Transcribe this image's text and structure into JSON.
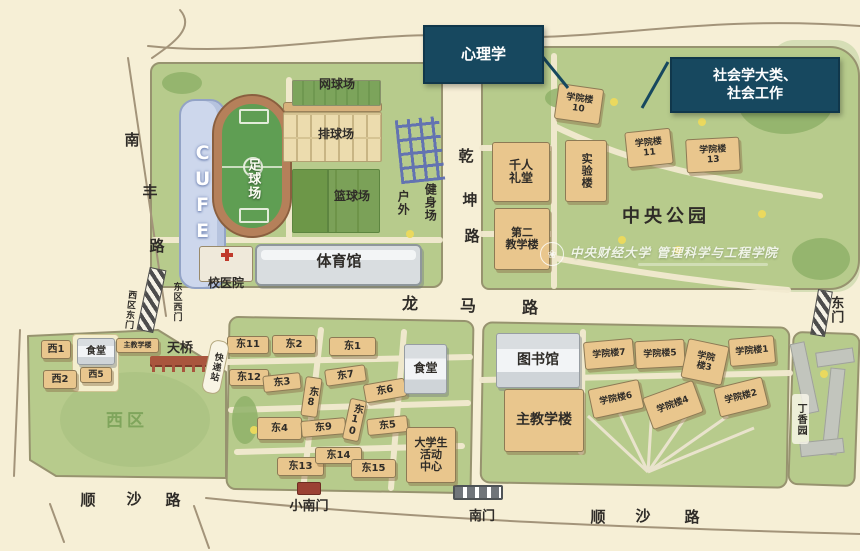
{
  "callouts": {
    "psychology": "心理学",
    "sociology": "社会学大类、\n社会工作"
  },
  "watermark": {
    "university": "中央财经大学",
    "school": "管理科学与工程学院",
    "logo_icon": "flower-emblem"
  },
  "map": {
    "colors": {
      "paper": "#f6efd6",
      "campus_green": "#b7cb8c",
      "building_tan": "#e9c68d",
      "building_gray": "#d9dde0",
      "callout_blue": "#17485f",
      "track_brown": "#b5805a",
      "field_green": "#5f9e53",
      "stand_blue": "#cdd7ec",
      "road_outline": "#a3947a"
    },
    "items": [
      {
        "n": "label-cufe-stand",
        "t": "CUFE",
        "x": 186,
        "y": 114,
        "w": 32,
        "h": 160,
        "c": "v cufe",
        "s": 19
      },
      {
        "n": "label-football-field",
        "t": "足球场",
        "x": 241,
        "y": 146,
        "w": 22,
        "h": 66,
        "c": "v white",
        "s": 13
      },
      {
        "n": "label-tennis-court",
        "t": "网球场",
        "x": 305,
        "y": 77,
        "w": 64,
        "h": 16,
        "c": "lab",
        "s": 12
      },
      {
        "n": "label-volleyball-court",
        "t": "排球场",
        "x": 304,
        "y": 127,
        "w": 64,
        "h": 16,
        "c": "lab",
        "s": 12
      },
      {
        "n": "label-basketball-court",
        "t": "篮球场",
        "x": 320,
        "y": 189,
        "w": 64,
        "h": 16,
        "c": "lab",
        "s": 12
      },
      {
        "n": "label-outdoor",
        "t": "户外",
        "x": 394,
        "y": 184,
        "w": 17,
        "h": 38,
        "c": "v lab",
        "s": 12
      },
      {
        "n": "label-fitness-area",
        "t": "健身场",
        "x": 421,
        "y": 174,
        "w": 17,
        "h": 56,
        "c": "v lab",
        "s": 12
      },
      {
        "n": "label-gymnasium",
        "t": "体育馆",
        "x": 296,
        "y": 250,
        "w": 86,
        "h": 22,
        "c": "lab",
        "s": 15
      },
      {
        "n": "label-school-hospital",
        "t": "校医院",
        "x": 198,
        "y": 276,
        "w": 56,
        "h": 16,
        "c": "lab",
        "s": 12
      },
      {
        "n": "road-nanfeng-char-1",
        "t": "南",
        "x": 122,
        "y": 130,
        "w": 20,
        "h": 20,
        "c": "lab",
        "s": 15
      },
      {
        "n": "road-nanfeng-char-2",
        "t": "丰",
        "x": 140,
        "y": 182,
        "w": 20,
        "h": 20,
        "c": "lab",
        "s": 15
      },
      {
        "n": "road-nanfeng-char-3",
        "t": "路",
        "x": 147,
        "y": 236,
        "w": 20,
        "h": 20,
        "c": "lab",
        "s": 15
      },
      {
        "n": "road-qiankun-char-1",
        "t": "乾",
        "x": 456,
        "y": 146,
        "w": 20,
        "h": 20,
        "c": "lab",
        "s": 15
      },
      {
        "n": "road-qiankun-char-2",
        "t": "坤",
        "x": 460,
        "y": 190,
        "w": 20,
        "h": 20,
        "c": "lab",
        "s": 15
      },
      {
        "n": "road-qiankun-char-3",
        "t": "路",
        "x": 462,
        "y": 226,
        "w": 20,
        "h": 20,
        "c": "lab",
        "s": 15
      },
      {
        "n": "road-longma-char-1",
        "t": "龙",
        "x": 400,
        "y": 294,
        "w": 20,
        "h": 20,
        "c": "lab",
        "s": 16
      },
      {
        "n": "road-longma-char-2",
        "t": "马",
        "x": 458,
        "y": 296,
        "w": 20,
        "h": 20,
        "c": "lab",
        "s": 16
      },
      {
        "n": "road-longma-char-3",
        "t": "路",
        "x": 520,
        "y": 298,
        "w": 20,
        "h": 20,
        "c": "lab",
        "s": 16
      },
      {
        "n": "road-shunsha-west-char-1",
        "t": "顺",
        "x": 78,
        "y": 490,
        "w": 20,
        "h": 20,
        "c": "lab",
        "s": 15
      },
      {
        "n": "road-shunsha-west-char-2",
        "t": "沙",
        "x": 124,
        "y": 489,
        "w": 20,
        "h": 20,
        "c": "lab",
        "s": 15
      },
      {
        "n": "road-shunsha-west-char-3",
        "t": "路",
        "x": 163,
        "y": 490,
        "w": 20,
        "h": 20,
        "c": "lab",
        "s": 15
      },
      {
        "n": "road-shunsha-east-char-1",
        "t": "顺",
        "x": 588,
        "y": 507,
        "w": 20,
        "h": 20,
        "c": "lab",
        "s": 15
      },
      {
        "n": "road-shunsha-east-char-2",
        "t": "沙",
        "x": 633,
        "y": 506,
        "w": 20,
        "h": 20,
        "c": "lab",
        "s": 15
      },
      {
        "n": "road-shunsha-east-char-3",
        "t": "路",
        "x": 682,
        "y": 507,
        "w": 20,
        "h": 20,
        "c": "lab",
        "s": 15
      },
      {
        "n": "label-east-gate",
        "t": "东门",
        "x": 826,
        "y": 288,
        "w": 18,
        "h": 44,
        "c": "v lab",
        "s": 13
      },
      {
        "n": "label-west-campus-east-gate",
        "t": "西区东门",
        "x": 122,
        "y": 281,
        "w": 15,
        "h": 58,
        "c": "v lab",
        "s": 9,
        "r": 6
      },
      {
        "n": "label-east-campus-west-gate",
        "t": "东区西门",
        "x": 169,
        "y": 273,
        "w": 15,
        "h": 58,
        "c": "v lab",
        "s": 9
      },
      {
        "n": "label-small-south-gate",
        "t": "小南门",
        "x": 282,
        "y": 499,
        "w": 54,
        "h": 16,
        "c": "lab",
        "s": 13
      },
      {
        "n": "label-south-gate",
        "t": "南门",
        "x": 460,
        "y": 509,
        "w": 44,
        "h": 16,
        "c": "lab",
        "s": 13
      },
      {
        "n": "building-college-10",
        "t": "学院楼\n10",
        "x": 556,
        "y": 86,
        "w": 46,
        "h": 36,
        "c": "bld",
        "s": 9,
        "r": 8
      },
      {
        "n": "building-college-11",
        "t": "学院楼\n11",
        "x": 626,
        "y": 130,
        "w": 46,
        "h": 36,
        "c": "bld",
        "s": 9,
        "r": -6
      },
      {
        "n": "building-college-13",
        "t": "学院楼\n13",
        "x": 686,
        "y": 138,
        "w": 54,
        "h": 34,
        "c": "bld",
        "s": 9,
        "r": -3
      },
      {
        "n": "building-thousand-people-hall",
        "t": "千人\n礼堂",
        "x": 492,
        "y": 142,
        "w": 58,
        "h": 60,
        "c": "bld",
        "s": 12
      },
      {
        "n": "building-laboratory",
        "t": "实验楼",
        "x": 565,
        "y": 140,
        "w": 42,
        "h": 62,
        "c": "bld v",
        "s": 11
      },
      {
        "n": "building-second-teaching",
        "t": "第二\n教学楼",
        "x": 494,
        "y": 208,
        "w": 56,
        "h": 62,
        "c": "bld",
        "s": 11
      },
      {
        "n": "label-central-park",
        "t": "中央公园",
        "x": 598,
        "y": 204,
        "w": 136,
        "h": 26,
        "c": "lab ls",
        "s": 18
      },
      {
        "n": "building-west-1",
        "t": "西1",
        "x": 41,
        "y": 340,
        "w": 30,
        "h": 19,
        "c": "bld",
        "s": 10
      },
      {
        "n": "building-west-2",
        "t": "西2",
        "x": 43,
        "y": 370,
        "w": 34,
        "h": 19,
        "c": "bld",
        "s": 10
      },
      {
        "n": "building-west-canteen",
        "t": "食堂",
        "x": 77,
        "y": 338,
        "w": 38,
        "h": 27,
        "c": "gray",
        "s": 10
      },
      {
        "n": "building-west-5",
        "t": "西5",
        "x": 80,
        "y": 367,
        "w": 32,
        "h": 16,
        "c": "bld",
        "s": 9
      },
      {
        "n": "building-west-main-teaching",
        "t": "主教学楼",
        "x": 116,
        "y": 338,
        "w": 43,
        "h": 15,
        "c": "bld",
        "s": 7
      },
      {
        "n": "label-west-campus",
        "t": "西区",
        "x": 92,
        "y": 410,
        "w": 70,
        "h": 24,
        "c": "lab green ls",
        "s": 17
      },
      {
        "n": "building-east-11",
        "t": "东11",
        "x": 227,
        "y": 336,
        "w": 42,
        "h": 18,
        "c": "bld",
        "s": 10
      },
      {
        "n": "building-east-2",
        "t": "东2",
        "x": 272,
        "y": 335,
        "w": 44,
        "h": 19,
        "c": "bld",
        "s": 10
      },
      {
        "n": "building-east-1",
        "t": "东1",
        "x": 329,
        "y": 337,
        "w": 47,
        "h": 19,
        "c": "bld",
        "s": 10
      },
      {
        "n": "building-east-12",
        "t": "东12",
        "x": 229,
        "y": 369,
        "w": 40,
        "h": 17,
        "c": "bld",
        "s": 10
      },
      {
        "n": "building-east-3",
        "t": "东3",
        "x": 263,
        "y": 374,
        "w": 38,
        "h": 17,
        "c": "bld",
        "s": 10,
        "r": -6
      },
      {
        "n": "building-east-8",
        "t": "东8",
        "x": 303,
        "y": 377,
        "w": 17,
        "h": 40,
        "c": "bld v",
        "s": 10,
        "r": 8
      },
      {
        "n": "building-east-7",
        "t": "东7",
        "x": 325,
        "y": 367,
        "w": 41,
        "h": 17,
        "c": "bld",
        "s": 10,
        "r": -8
      },
      {
        "n": "building-east-6",
        "t": "东6",
        "x": 364,
        "y": 381,
        "w": 42,
        "h": 19,
        "c": "bld",
        "s": 10,
        "r": -10
      },
      {
        "n": "building-east-4",
        "t": "东4",
        "x": 257,
        "y": 417,
        "w": 45,
        "h": 23,
        "c": "bld",
        "s": 10
      },
      {
        "n": "building-east-9",
        "t": "东9",
        "x": 301,
        "y": 419,
        "w": 45,
        "h": 17,
        "c": "bld",
        "s": 10,
        "r": -5
      },
      {
        "n": "building-east-10",
        "t": "东10",
        "x": 346,
        "y": 399,
        "w": 17,
        "h": 42,
        "c": "bld v",
        "s": 10,
        "r": 12
      },
      {
        "n": "building-east-5",
        "t": "东5",
        "x": 367,
        "y": 417,
        "w": 41,
        "h": 17,
        "c": "bld",
        "s": 10,
        "r": -6
      },
      {
        "n": "building-east-13",
        "t": "东13",
        "x": 277,
        "y": 457,
        "w": 47,
        "h": 19,
        "c": "bld",
        "s": 10
      },
      {
        "n": "building-east-14",
        "t": "东14",
        "x": 315,
        "y": 447,
        "w": 47,
        "h": 17,
        "c": "bld",
        "s": 10
      },
      {
        "n": "building-east-15",
        "t": "东15",
        "x": 351,
        "y": 459,
        "w": 45,
        "h": 19,
        "c": "bld",
        "s": 10
      },
      {
        "n": "building-east-canteen",
        "t": "食堂",
        "x": 404,
        "y": 344,
        "w": 43,
        "h": 50,
        "c": "gray",
        "s": 12
      },
      {
        "n": "building-student-activity-center",
        "t": "大学生\n活动\n中心",
        "x": 406,
        "y": 427,
        "w": 50,
        "h": 56,
        "c": "bld",
        "s": 11
      },
      {
        "n": "building-library",
        "t": "图书馆",
        "x": 496,
        "y": 333,
        "w": 84,
        "h": 55,
        "c": "gray",
        "s": 14
      },
      {
        "n": "building-main-teaching",
        "t": "主教学楼",
        "x": 504,
        "y": 389,
        "w": 80,
        "h": 63,
        "c": "bld",
        "s": 14
      },
      {
        "n": "building-college-7",
        "t": "学院楼7",
        "x": 584,
        "y": 340,
        "w": 50,
        "h": 28,
        "c": "bld",
        "s": 9,
        "r": -5
      },
      {
        "n": "building-college-5",
        "t": "学院楼5",
        "x": 635,
        "y": 340,
        "w": 50,
        "h": 28,
        "c": "bld",
        "s": 9,
        "r": -3
      },
      {
        "n": "building-college-3",
        "t": "学院\n楼3",
        "x": 684,
        "y": 342,
        "w": 42,
        "h": 40,
        "c": "bld",
        "s": 9,
        "r": 12
      },
      {
        "n": "building-college-1",
        "t": "学院楼1",
        "x": 729,
        "y": 337,
        "w": 46,
        "h": 28,
        "c": "bld",
        "s": 9,
        "r": -5
      },
      {
        "n": "building-college-6",
        "t": "学院楼6",
        "x": 590,
        "y": 384,
        "w": 52,
        "h": 30,
        "c": "bld",
        "s": 9,
        "r": -12
      },
      {
        "n": "building-college-4",
        "t": "学院楼4",
        "x": 646,
        "y": 388,
        "w": 54,
        "h": 34,
        "c": "bld",
        "s": 9,
        "r": -20
      },
      {
        "n": "building-college-2",
        "t": "学院楼2",
        "x": 716,
        "y": 382,
        "w": 50,
        "h": 30,
        "c": "bld",
        "s": 9,
        "r": -14
      },
      {
        "n": "label-lilac-garden",
        "t": "丁香园",
        "x": 792,
        "y": 394,
        "w": 17,
        "h": 50,
        "c": "v lab chip",
        "s": 10
      },
      {
        "n": "label-overpass",
        "t": "天桥",
        "x": 158,
        "y": 341,
        "w": 44,
        "h": 17,
        "c": "lab",
        "s": 13
      },
      {
        "n": "label-express-station",
        "t": "快递站",
        "x": 206,
        "y": 340,
        "w": 19,
        "h": 54,
        "c": "v pkg",
        "s": 9,
        "r": 12
      }
    ]
  }
}
